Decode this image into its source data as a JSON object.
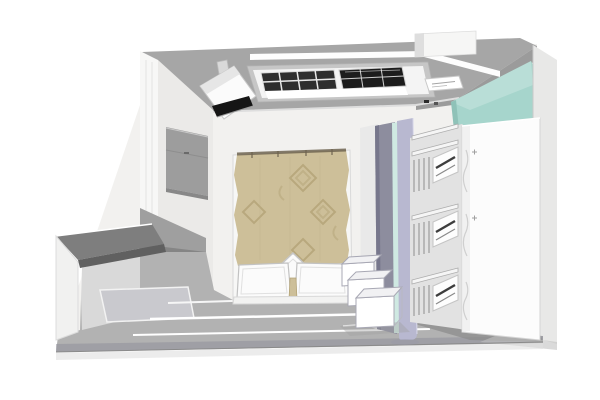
{
  "meta": {
    "scene": "3D interior render of a bedroom, elevated cutaway view from the front",
    "room": "bedroom",
    "visible_text": ""
  },
  "objects": {
    "ceiling": "gray ceiling slab with recessed vent soffit",
    "linear_light": "white linear light strip at ceiling step",
    "ac_vents": "two dark louver grilles in ceiling soffit",
    "vent_label_slot": "small white slot with fine gray markings",
    "duct_box": "white duct box on top of ceiling",
    "projector": "white ceiling-mounted projector with dark lens slot",
    "teal_accent_wall": "teal painted wall section, top right",
    "right_wall": "light gray right wall edge",
    "left_wall": "cutaway left wall with gray band",
    "wall_cabinet": "gray floating cabinet on left wall",
    "desk": "dark-topped desk attached to cutaway front wall",
    "bed": "double bed with tan quilted duvet, two white pillows and a diamond cushion",
    "partition": "tall divider: gray, mint glass stripe and lavender panels",
    "wardrobe": "open white wardrobe with shelves, drawers and hanging clothes",
    "wardrobe_front_panel": "tall white wardrobe side panel",
    "storage_boxes": "three open white storage boxes at foot of bed",
    "floor": "gray floor with light plank strips and rug",
    "shadows": "soft floor shadows under wardrobe and front edge"
  },
  "colors": {
    "room_wall": "#f2f1ef",
    "ceiling": "#a6a6a6",
    "light_strip": "#fdfdfd",
    "duct": "#f6f6f5",
    "vent_panel": "#f4f4f4",
    "vent_dark": "#2e2e2e",
    "vent_darker": "#1c1c1c",
    "teal_wall": "#a6d5cc",
    "right_wall": "#e8e8e7",
    "left_wall_outer": "#f7f7f6",
    "left_wall_inner": "#ebeae8",
    "cabinet": "#9d9d9d",
    "wall_wedge": "#9f9f9f",
    "desk_top": "#7e7e7e",
    "desk_under": "#606060",
    "desk_support": "#f1f1f0",
    "floor": "#b2b2b2",
    "floor_front": "#8f8f9a",
    "rug": "#c9c9ce",
    "duvet": "#cdbf99",
    "duvet_motif": "#b3a377",
    "duvet_edge": "#6f6450",
    "pillow": "#fbfbfb",
    "partition_gray": "#8d8d9e",
    "partition_mint": "#cfe9e2",
    "partition_lavender": "#b8b8d0",
    "wardrobe_panel": "#fcfcfc",
    "wardrobe_interior": "#e2e2e2",
    "drawer_handle": "#3d3d3d",
    "box_white": "#ffffff",
    "box_line": "#a8a8b4",
    "shadow": "#8c8c8c",
    "projector": "#fbfbfb",
    "projector_slot": "#151515"
  }
}
